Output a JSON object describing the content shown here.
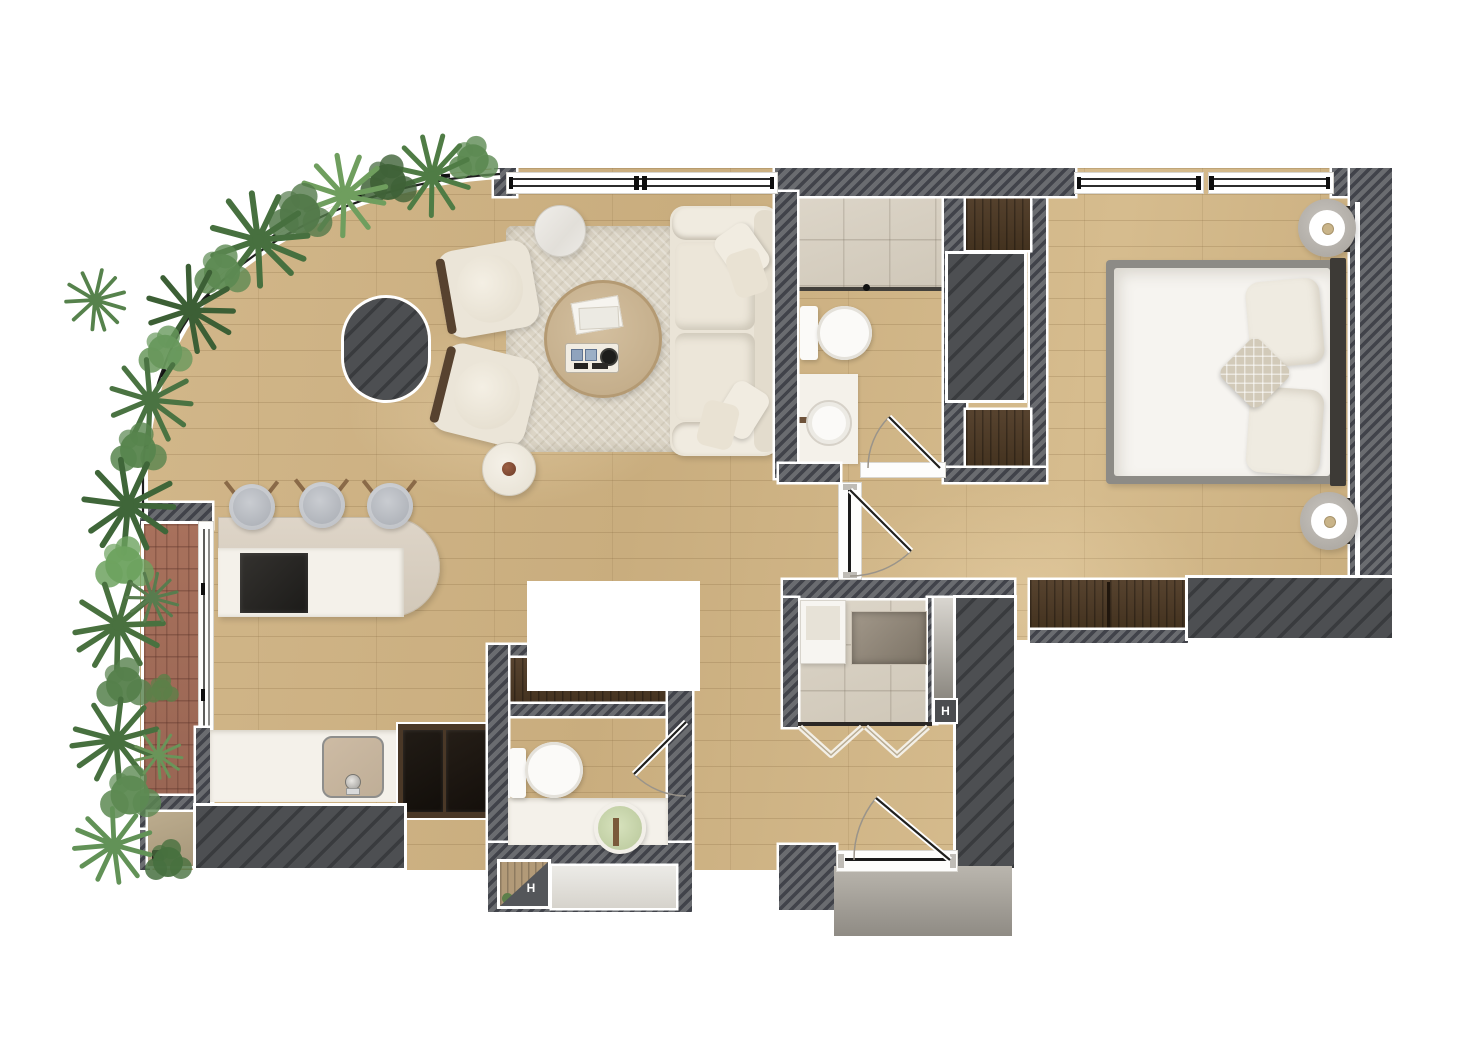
{
  "meta": {
    "title": "apartment-floor-plan",
    "canvas_width": 1462,
    "canvas_height": 1061,
    "description": "Top-down rendered floor plan of a one-bedroom apartment with curved glazed facade and planted edge"
  },
  "labels": {
    "shaft_marker_1": "H",
    "shaft_marker_2": "H"
  },
  "colors": {
    "bg": "#ffffff",
    "wall-light": "#6a6c70",
    "wall-dark": "#41434a",
    "block-light": "#4d4f52",
    "block-dark": "#393b3e",
    "wood-base": "#ccb083",
    "tile": "#d8d1c4",
    "tile-line": "#b3ab99",
    "brick": "#a5715c",
    "brick-line": "#6e4336",
    "rug": "#dcd5c6",
    "sofa": "#eae4d7",
    "sofa-shade": "#d9d1bf",
    "table-wood": "#c8b191",
    "marble": "#edebe7",
    "island-beige": "#d9d0c2",
    "counter-white": "#f4f1ea",
    "cooktop": "#262523",
    "appliance": "#191512",
    "cabinet-wood": "#4a3827",
    "closet-wood": "#4e3b29",
    "stool": "#b7bac0",
    "bed-frame": "#8d8b86",
    "mattress": "#f6f4f0",
    "headboard": "#3d3a36",
    "pillow": "#efebe1",
    "accent-pillow": "#d2cab9",
    "lamp-outer": "#b5b1ab",
    "lamp-dot": "#c9b489",
    "fixture-white": "#fbfaf8",
    "basin-green": "#c9d6ab",
    "mat-light": "#bab6ae",
    "mat-dark": "#8f8b84",
    "glass-line": "#1e1e1e",
    "door-line": "#1b1b1b"
  },
  "rooms": [
    {
      "name": "living-room"
    },
    {
      "name": "kitchen"
    },
    {
      "name": "balcony"
    },
    {
      "name": "bathroom"
    },
    {
      "name": "shower-room"
    },
    {
      "name": "wc"
    },
    {
      "name": "hallway"
    },
    {
      "name": "bedroom"
    },
    {
      "name": "entry"
    }
  ],
  "furniture": {
    "living_room": [
      "sofa",
      "armchair",
      "armchair",
      "round-coffee-table",
      "marble-side-table",
      "side-stool",
      "area-rug",
      "hatched-column"
    ],
    "kitchen": [
      "island-with-cooktop",
      "bar-stool",
      "bar-stool",
      "bar-stool",
      "counter-with-sink",
      "tall-appliances"
    ],
    "bedroom": [
      "double-bed",
      "pillows",
      "nightstand-lamp",
      "nightstand-lamp",
      "dresser",
      "closet",
      "closet"
    ],
    "bathroom": [
      "walk-in-shower",
      "toilet",
      "vanity-basin"
    ],
    "wc": [
      "toilet",
      "vanity-basin",
      "wardrobe"
    ],
    "shower_room": [
      "shower-tray",
      "cabinet",
      "bifold-doors",
      "service-slot"
    ],
    "balcony": [
      "brick-deck",
      "sliding-glass-door",
      "plants"
    ],
    "entry": [
      "entry-door",
      "doormat"
    ]
  },
  "windows": [
    "living-room-window",
    "bedroom-window-left",
    "bedroom-window-right",
    "curved-glass-facade"
  ]
}
